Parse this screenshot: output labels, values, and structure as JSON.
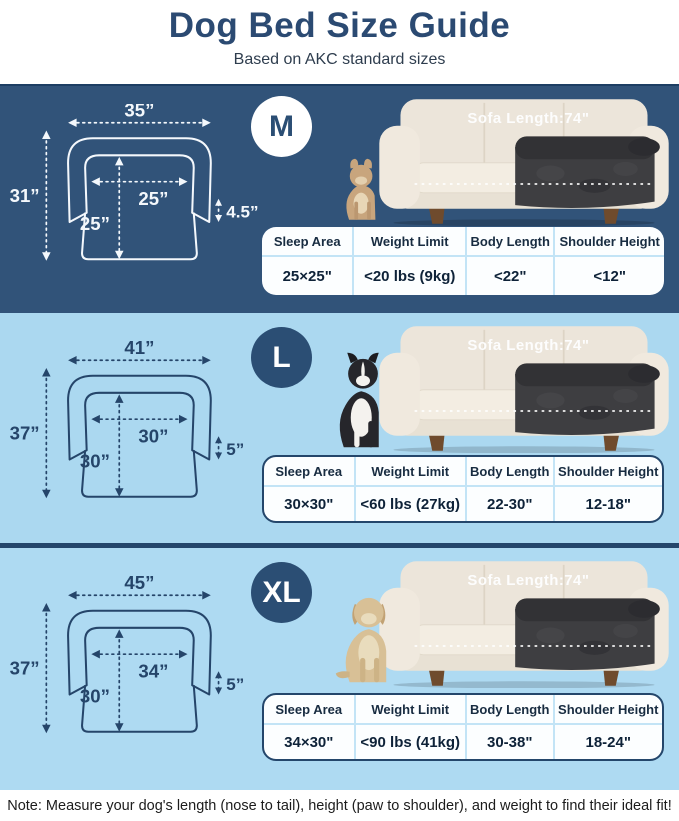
{
  "header": {
    "title": "Dog Bed Size Guide",
    "subtitle": "Based on AKC standard sizes"
  },
  "colors": {
    "navy_section_bg": "#315379",
    "light_blue_bg": "#abd8f0",
    "divider_navy": "#24466b",
    "badge_navy": "#2b4e74",
    "title_navy": "#2b4a72",
    "table_divider_blue": "#c3e4f6",
    "diagram_line_on_navy": "#f4f8fc",
    "diagram_line_on_blue": "#25456a"
  },
  "table_headers": [
    "Sleep Area",
    "Weight Limit",
    "Body Length",
    "Shoulder Height"
  ],
  "sections": [
    {
      "size_label": "M",
      "dog_image": "french-bulldog",
      "sofa_label": "Sofa Length:74\"",
      "dims": {
        "overall_width": "35”",
        "overall_height": "31”",
        "inner_width": "25”",
        "inner_depth": "25”",
        "bolster_height": "4.5”"
      },
      "table": {
        "sleep_area": "25×25\"",
        "weight_limit": "<20 lbs (9kg)",
        "body_length": "<22\"",
        "shoulder_height": "<12\""
      }
    },
    {
      "size_label": "L",
      "dog_image": "border-collie",
      "sofa_label": "Sofa Length:74\"",
      "dims": {
        "overall_width": "41”",
        "overall_height": "37”",
        "inner_width": "30”",
        "inner_depth": "30”",
        "bolster_height": "5”"
      },
      "table": {
        "sleep_area": "30×30\"",
        "weight_limit": "<60 lbs (27kg)",
        "body_length": "22-30\"",
        "shoulder_height": "12-18\""
      }
    },
    {
      "size_label": "XL",
      "dog_image": "golden-retriever",
      "sofa_label": "Sofa Length:74\"",
      "dims": {
        "overall_width": "45”",
        "overall_height": "37”",
        "inner_width": "34”",
        "inner_depth": "30”",
        "bolster_height": "5”"
      },
      "table": {
        "sleep_area": "34×30\"",
        "weight_limit": "<90 lbs (41kg)",
        "body_length": "30-38\"",
        "shoulder_height": "18-24\""
      }
    }
  ],
  "footer": {
    "note": "Note: Measure your dog's length (nose to tail), height (paw to shoulder), and weight to find their ideal fit!"
  }
}
